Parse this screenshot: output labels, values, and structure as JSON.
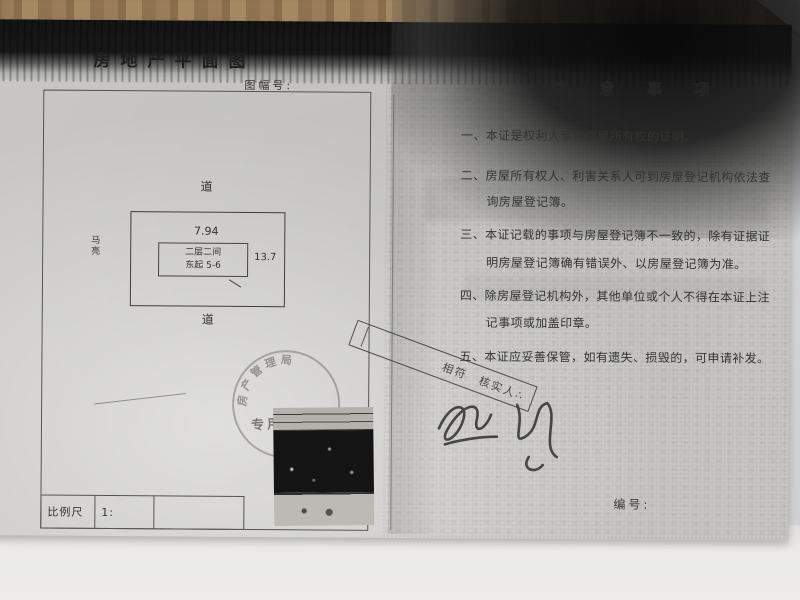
{
  "document": {
    "left_page": {
      "title": "房地产平面图",
      "sheet_no_label": "图幅号:",
      "plan": {
        "road_top": "道",
        "road_bottom": "道",
        "west_neighbor": "马亮",
        "top_dimension": "7.94",
        "side_dimension": "13.7",
        "building_label_line1": "二层二间",
        "building_label_line2": "东起 5-6"
      },
      "scale": {
        "label": "比例尺",
        "value": "1:"
      },
      "round_stamp": {
        "arc_text": "房产管理局",
        "center_text": "专用章"
      },
      "verify_stamp": {
        "text": "相符　核实人∴"
      }
    },
    "right_page": {
      "title": "注 意 事 项",
      "lines": [
        "一、本证是权利人享有房屋所有权的证明。",
        "二、房屋所有权人、利害关系人可到房屋登记机构依法查",
        "询房屋登记簿。",
        "三、本证记载的事项与房屋登记簿不一致的，除有证据证",
        "明房屋登记簿确有错误外、以房屋登记簿为准。",
        "四、除房屋登记机构外，其他单位或个人不得在本证上注",
        "记事项或加盖印章。",
        "五、本证应妥善保管，如有遗失、损毁的，可申请补发。"
      ],
      "serial_label": "编号:"
    },
    "colors": {
      "paper_gray": "#c7c6c3",
      "photocopy_black": "#151515",
      "desk_wood": "#9a7d58",
      "under_page_white": "#ecebe7"
    }
  }
}
